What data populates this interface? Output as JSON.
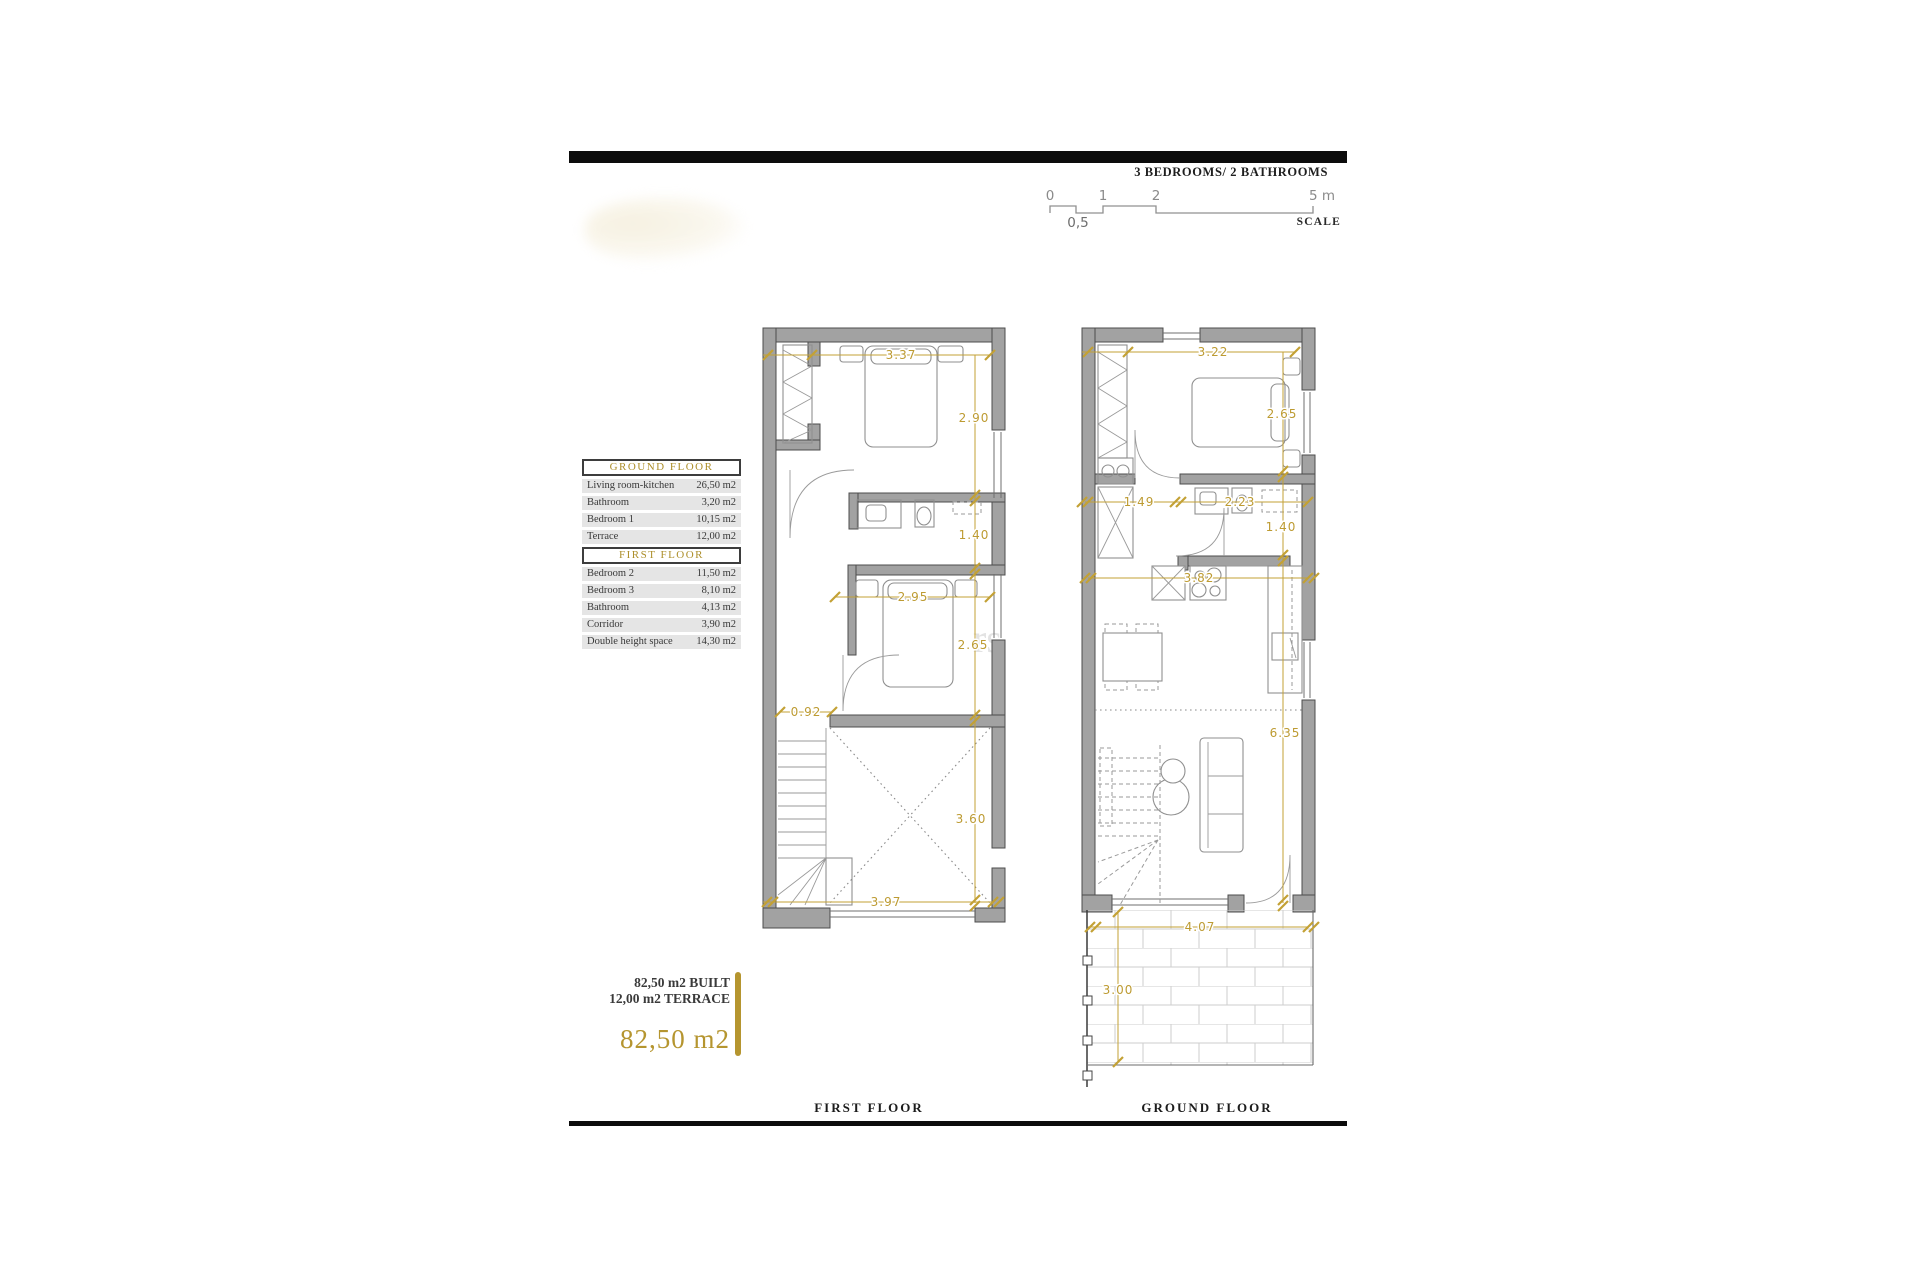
{
  "header": {
    "subtitle": "3 BEDROOMS/ 2 BATHROOMS"
  },
  "scale_bar": {
    "tick_0": "0",
    "tick_1": "1",
    "tick_2": "2",
    "tick_5": "5 m",
    "half": "0,5",
    "label": "SCALE"
  },
  "area_tables": {
    "ground": {
      "title": "GROUND FLOOR",
      "rows": [
        {
          "name": "Living room-kitchen",
          "value": "26,50 m2"
        },
        {
          "name": "Bathroom",
          "value": "3,20 m2"
        },
        {
          "name": "Bedroom 1",
          "value": "10,15 m2"
        },
        {
          "name": "Terrace",
          "value": "12,00 m2"
        }
      ]
    },
    "first": {
      "title": "FIRST FLOOR",
      "rows": [
        {
          "name": "Bedroom 2",
          "value": "11,50 m2"
        },
        {
          "name": "Bedroom 3",
          "value": "8,10 m2"
        },
        {
          "name": "Bathroom",
          "value": "4,13 m2"
        },
        {
          "name": "Corridor",
          "value": "3,90 m2"
        },
        {
          "name": "Double height space",
          "value": "14,30 m2"
        }
      ]
    }
  },
  "summary": {
    "built": "82,50 m2 BUILT",
    "terrace": "12,00 m2 TERRACE",
    "total": "82,50 m2"
  },
  "floor_labels": {
    "first": "FIRST FLOOR",
    "ground": "GROUND FLOOR"
  },
  "dims": {
    "ff": {
      "top": "3.37",
      "right1": "2.90",
      "right2": "1.40",
      "mid": "2.95",
      "right3": "2.65",
      "left": "0.92",
      "right4": "3.60",
      "bottom": "3.97"
    },
    "gf": {
      "top": "3.22",
      "right1": "2.65",
      "bath_left": "1.49",
      "bath_right": "2.23",
      "right2": "1.40",
      "width": "3.82",
      "right3": "6.35",
      "bottom": "4.07",
      "terrace": "3.00"
    }
  },
  "watermark": "rs",
  "colors": {
    "accent_gold": "#b5952f",
    "dim_gold": "#c3a135",
    "bar_black": "#0c0c0c",
    "wall_gray": "#a2a2a2",
    "row_gray": "#e5e5e5"
  }
}
